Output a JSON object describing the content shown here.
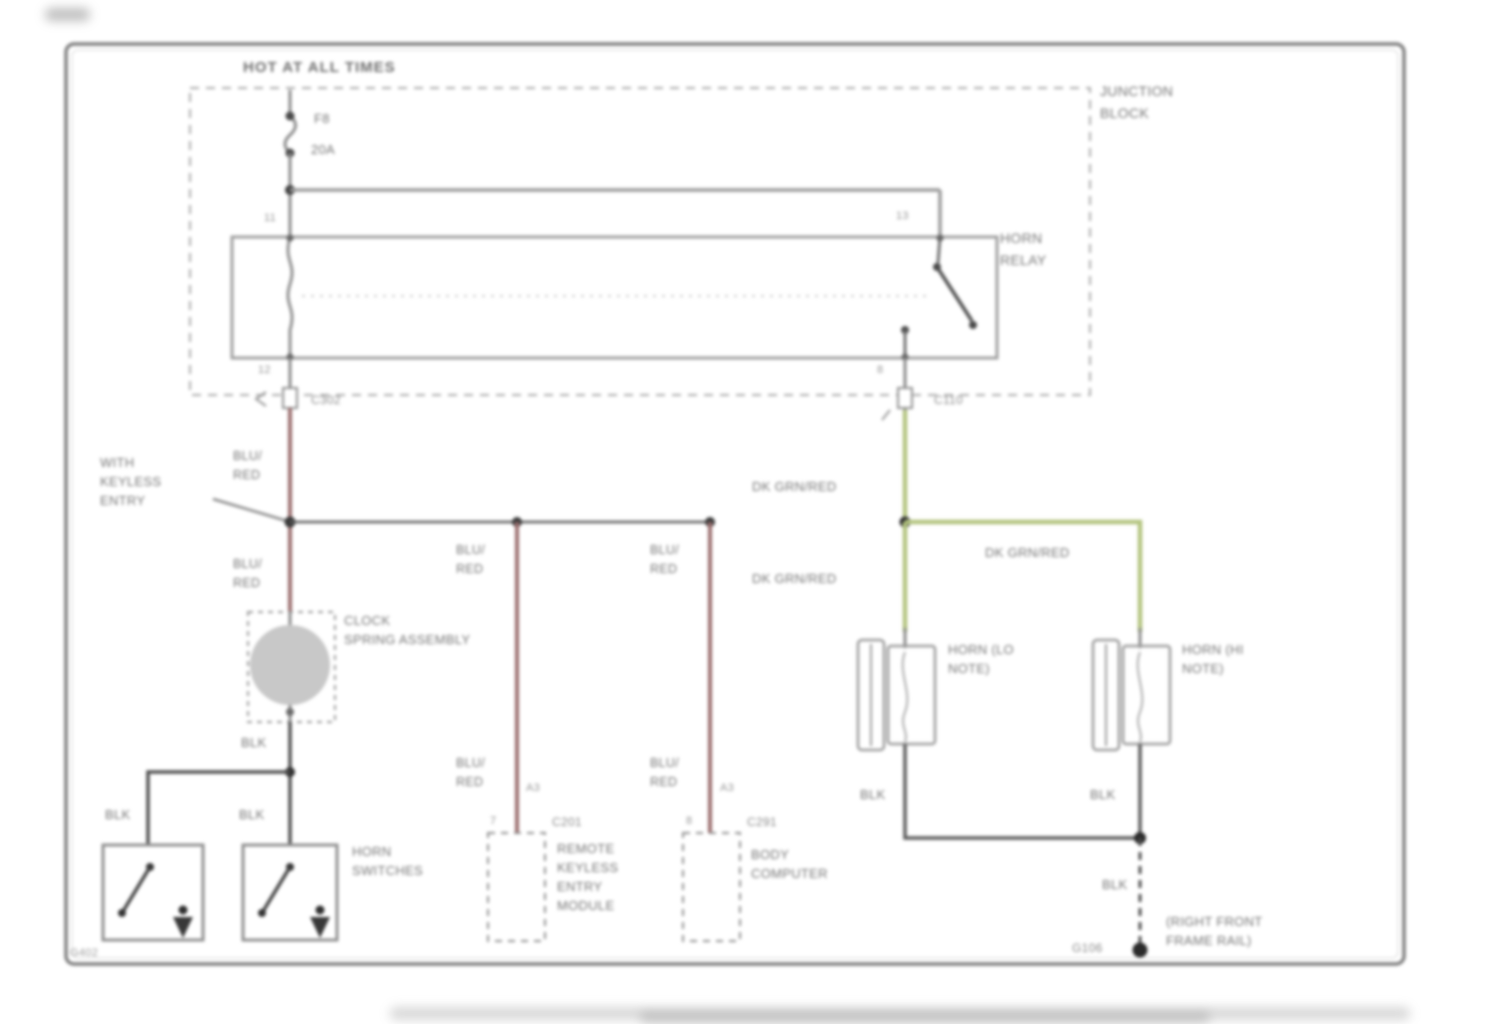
{
  "colors": {
    "wire_red": "#9b6e6e",
    "wire_green": "#b3c47f",
    "wire_black": "#4e4e4e",
    "line_gray": "#9a9a9a"
  },
  "labels": {
    "hot_at_all_times": "HOT AT ALL TIMES",
    "fuse_name": "F8",
    "fuse_rating": "20A",
    "junction_block_1": "JUNCTION",
    "junction_block_2": "BLOCK",
    "horn_relay_1": "HORN",
    "horn_relay_2": "RELAY",
    "relay_pin_top_left": "11",
    "relay_pin_top_right": "13",
    "relay_pin_bottom_left": "12",
    "relay_pin_bottom_right": "8",
    "connector_c302": "C302",
    "connector_c110": "C110",
    "wire_blu_red_1": "BLU/",
    "wire_blu_red_2": "RED",
    "wire_dk_grn_red": "DK GRN/RED",
    "wire_blk": "BLK",
    "with_keyless_1": "WITH",
    "with_keyless_2": "KEYLESS",
    "with_keyless_3": "ENTRY",
    "clock_spring_1": "CLOCK",
    "clock_spring_2": "SPRING ASSEMBLY",
    "module_pin_left": "7",
    "module_pin_right": "8",
    "module_wire_pin": "A3",
    "connector_c201": "C201",
    "connector_c291": "C291",
    "rkem_1": "REMOTE",
    "rkem_2": "KEYLESS",
    "rkem_3": "ENTRY",
    "rkem_4": "MODULE",
    "body_computer_1": "BODY",
    "body_computer_2": "COMPUTER",
    "horn_switches_1": "HORN",
    "horn_switches_2": "SWITCHES",
    "ground_switch": "G402",
    "horn_lo_1": "HORN (LO",
    "horn_lo_2": "NOTE)",
    "horn_hi_1": "HORN (HI",
    "horn_hi_2": "NOTE)",
    "ground_frame": "G106",
    "frame_rail_1": "(RIGHT FRONT",
    "frame_rail_2": "FRAME RAIL)"
  }
}
